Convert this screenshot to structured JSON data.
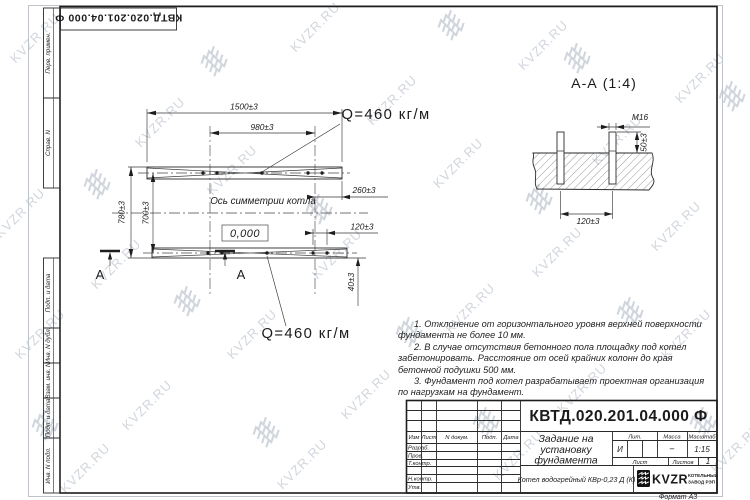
{
  "page": {
    "format_label": "Формат А3"
  },
  "corner_stamp": {
    "doc_number": "КВТД.020.201.04.000 Ф"
  },
  "side_strip": {
    "perv_primen": "Перв. примен.",
    "sprav_n": "Справ. N",
    "podp_data_1": "Подп. и дата",
    "inv_n_dubl": "Инв. N дубл.",
    "vzam_inv_n": "Взам. инв. N",
    "podp_data_2": "Подп. и дата",
    "inv_n_podl": "Инв. N подл."
  },
  "plan": {
    "dim_length_outer": "1500±3",
    "dim_length_axes": "980±3",
    "dim_width_outer": "780±3",
    "dim_width_axes": "700±3",
    "dim_edge": "260±3",
    "dim_bolt_pair": "120±3",
    "dim_offset": "40±3",
    "load_top": "Q=460 кг/м",
    "load_bottom": "Q=460 кг/м",
    "symmetry_axis": "Ось симметрии котла",
    "elevation": "0,000",
    "section_letter_left": "A",
    "section_letter_mid": "A"
  },
  "section_view": {
    "title": "А-А (1:4)",
    "thread": "М16",
    "dim_protrusion": "50±3",
    "dim_spacing": "120±3"
  },
  "notes": {
    "n1": "1. Отклонение от горизонтального уровня верхней поверхности фундамента не более 10 мм.",
    "n2": "2. В случае отсутствия бетонного пола площадку под котел забетонировать. Расстояние от осей крайних колонн до края бетонной подушки 500 мм.",
    "n3": "3. Фундамент под котел разрабатывает проектная организация по нагрузкам на фундамент."
  },
  "title_block": {
    "doc_number": "КВТД.020.201.04.000 Ф",
    "title_line1": "Задание на",
    "title_line2": "установку",
    "title_line3": "фундамента",
    "product": "Котел водогрейный КВр-0,23 Д (К)",
    "col_izm": "Изм",
    "col_list": "Лист",
    "col_ndokum": "N докум.",
    "col_podp": "Подп.",
    "col_data": "Дата",
    "row_razrab": "Разраб.",
    "row_prov": "Пров.",
    "row_tkontr": "Т.контр.",
    "row_nkontr": "Н.контр.",
    "row_utv": "Утв.",
    "lit_label": "Лит.",
    "lit_value": "И",
    "massa_label": "Масса",
    "massa_value": "–",
    "masshtab_label": "Масштаб",
    "masshtab_value": "1:15",
    "list_label": "Лист",
    "listov_label": "Листов",
    "listov_value": "1",
    "logo_text": "KVZR",
    "logo_sub1": "КОТЕЛЬНЫЙ",
    "logo_sub2": "ЗАВОД РЭП"
  },
  "watermark": {
    "text": "KVZR.RU",
    "color": "#c9cfd8",
    "text_positions": [
      [
        35,
        38
      ],
      [
        315,
        27
      ],
      [
        543,
        45
      ],
      [
        700,
        78
      ],
      [
        160,
        122
      ],
      [
        392,
        100
      ],
      [
        617,
        140
      ],
      [
        20,
        213
      ],
      [
        232,
        170
      ],
      [
        458,
        163
      ],
      [
        676,
        226
      ],
      [
        116,
        264
      ],
      [
        337,
        254
      ],
      [
        557,
        252
      ],
      [
        40,
        334
      ],
      [
        252,
        334
      ],
      [
        470,
        308
      ],
      [
        686,
        334
      ],
      [
        147,
        405
      ],
      [
        366,
        394
      ],
      [
        582,
        388
      ],
      [
        85,
        468
      ],
      [
        302,
        464
      ],
      [
        518,
        455
      ],
      [
        736,
        448
      ]
    ],
    "logo_positions": [
      [
        215,
        60
      ],
      [
        452,
        24
      ],
      [
        733,
        95
      ],
      [
        98,
        183
      ],
      [
        320,
        208
      ],
      [
        540,
        198
      ],
      [
        188,
        300
      ],
      [
        410,
        331
      ],
      [
        631,
        311
      ],
      [
        46,
        424
      ],
      [
        267,
        431
      ],
      [
        487,
        421
      ],
      [
        704,
        421
      ],
      [
        578,
        57
      ]
    ]
  }
}
